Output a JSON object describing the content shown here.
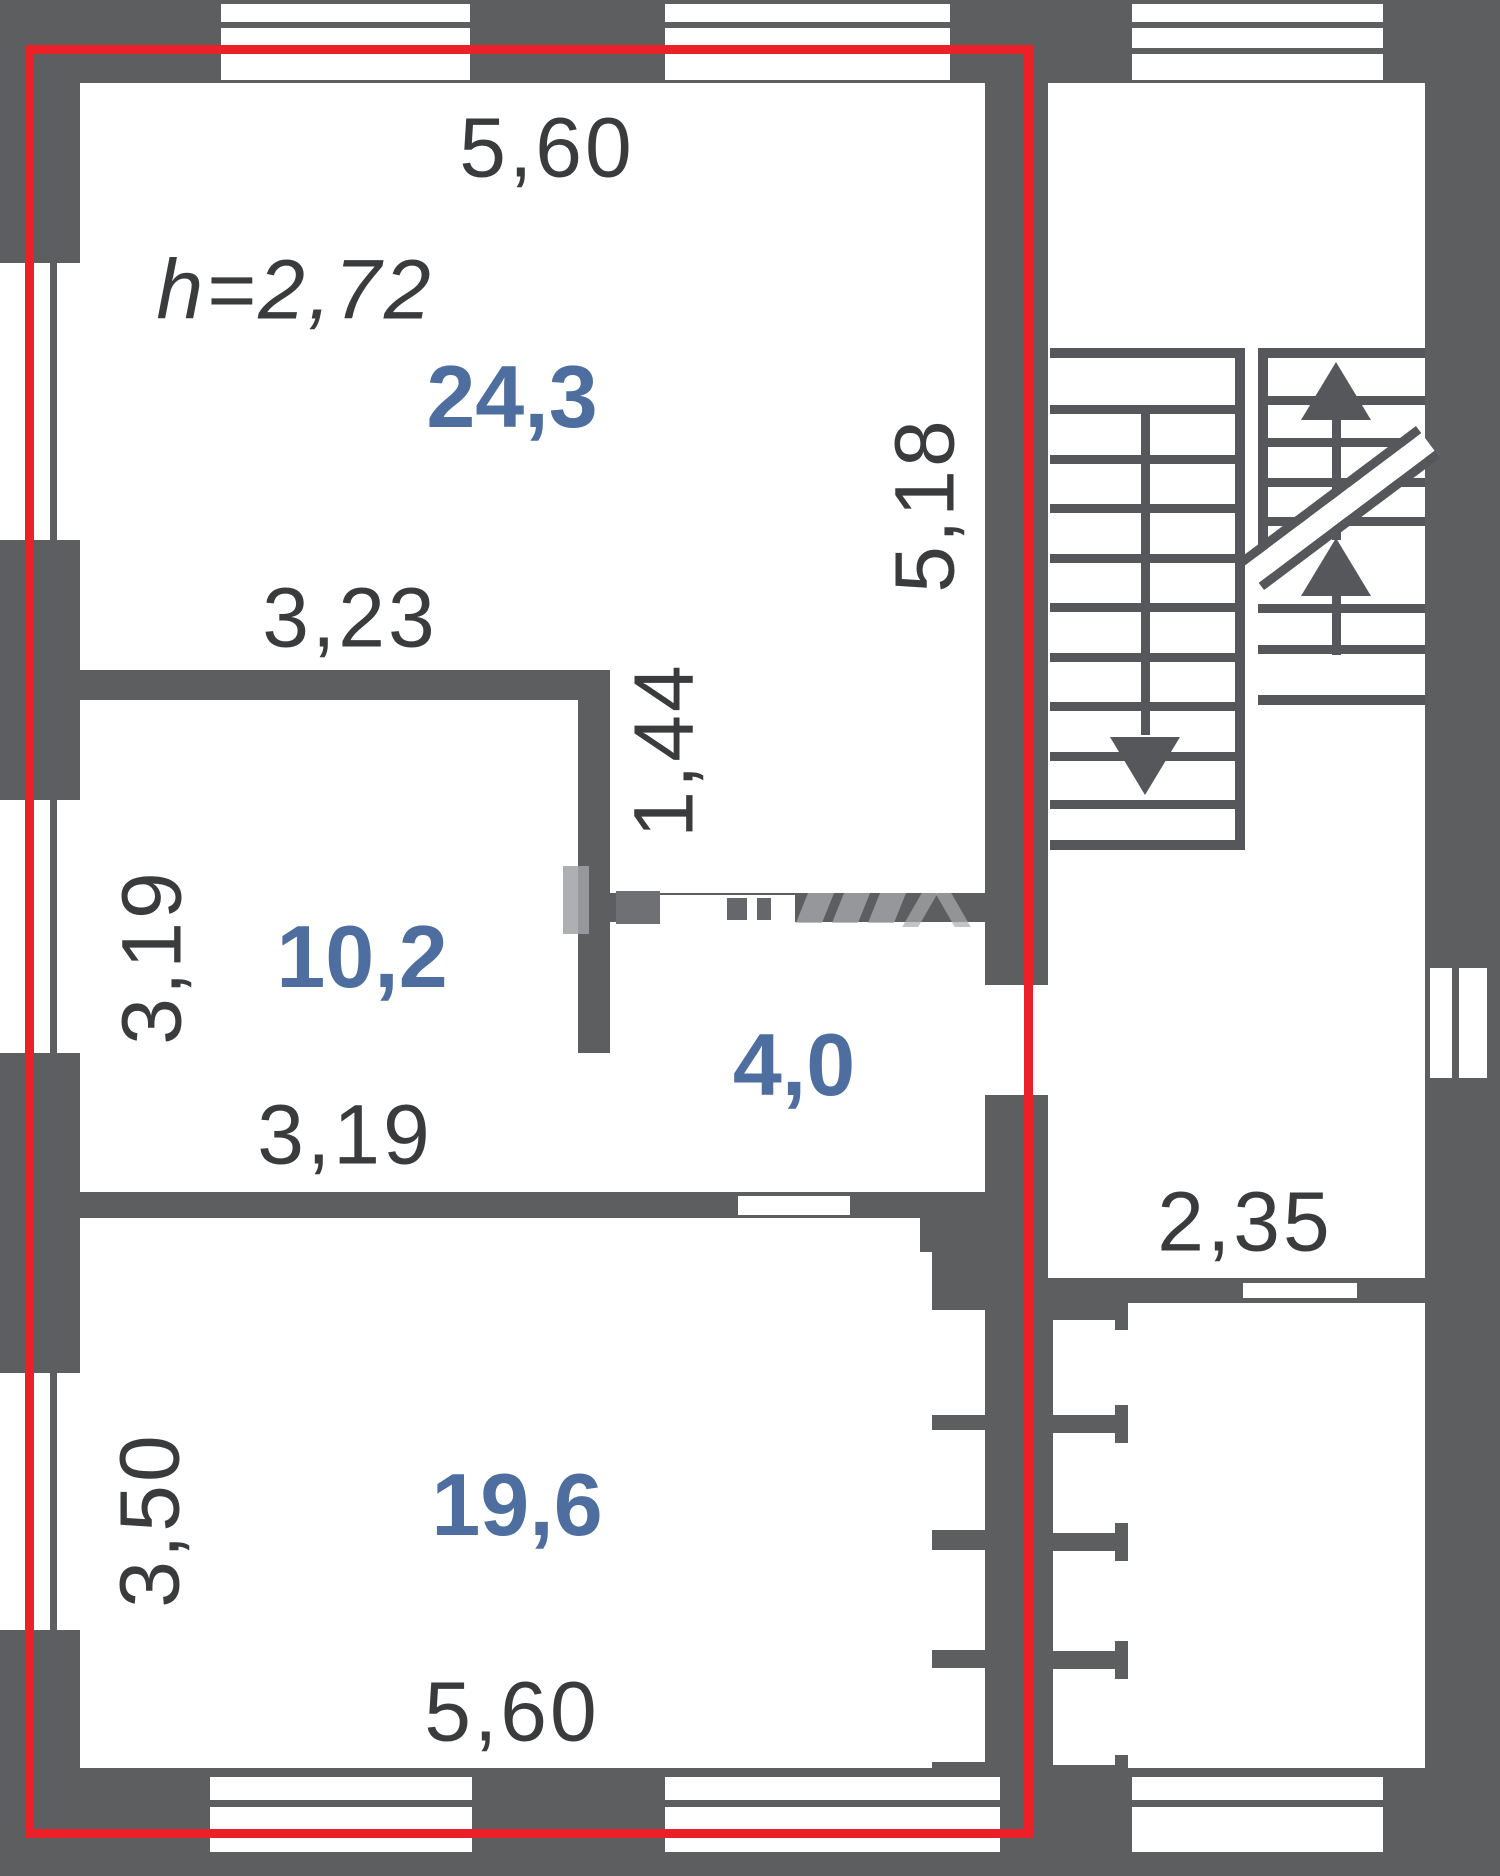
{
  "meta": {
    "type": "apartment floor plan",
    "highlight": "selected unit outlined in red"
  },
  "colors": {
    "wall": "#5d5e60",
    "outline_red": "#ec2127",
    "area_label_blue": "#4d6e9e",
    "dimension_text": "#3a3b3d"
  },
  "rooms": [
    {
      "name": "living-room",
      "area": "24,3"
    },
    {
      "name": "bedroom",
      "area": "10,2"
    },
    {
      "name": "hall",
      "area": "4,0"
    },
    {
      "name": "kitchen-living",
      "area": "19,6"
    }
  ],
  "labels": {
    "top_width": "5,60",
    "ceiling_height": "h=2,72",
    "living_area": "24,3",
    "living_height": "5,18",
    "bedroom_top_width": "3,23",
    "hall_wall_length": "1,44",
    "bedroom_area": "10,2",
    "bedroom_left_height": "3,19",
    "bedroom_bottom_width": "3,19",
    "hall_area": "4,0",
    "corridor_width": "2,35",
    "kitchen_area": "19,6",
    "kitchen_left_height": "3,50",
    "bottom_width": "5,60"
  },
  "stairs": {
    "flights": 2,
    "down_arrow_icon": "down-arrow",
    "up_arrow_icon": "up-arrow"
  }
}
